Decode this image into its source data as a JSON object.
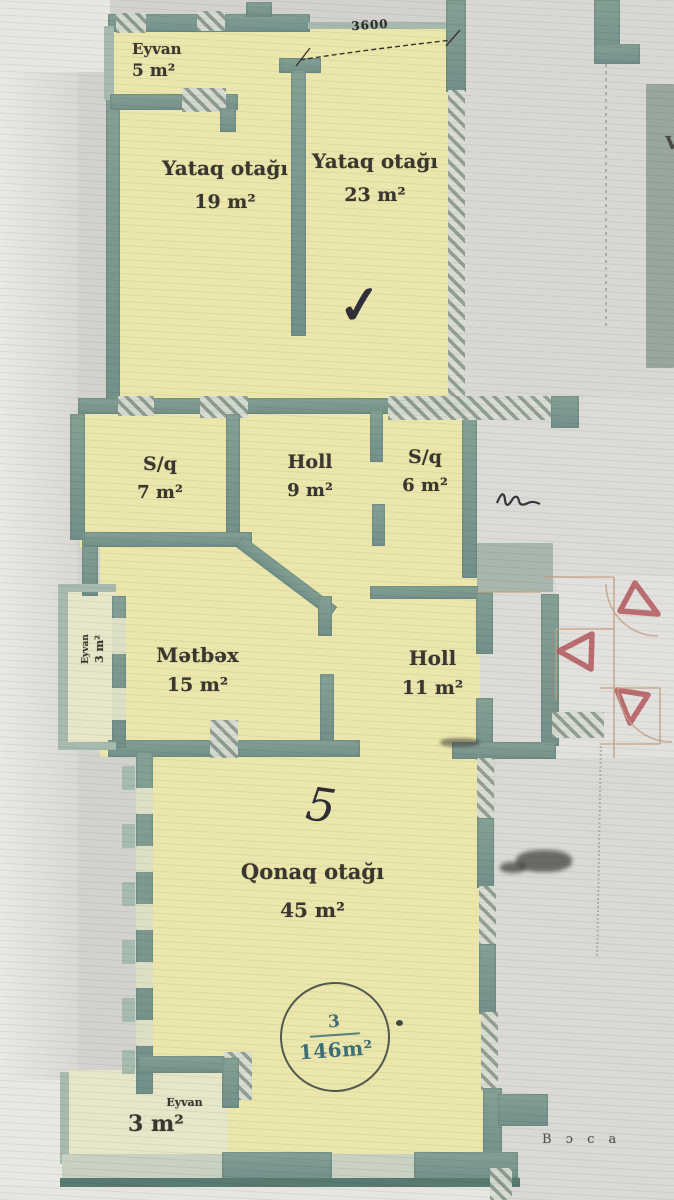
{
  "plan": {
    "rooms": [
      {
        "name": "Eyvan",
        "area": "5 m²"
      },
      {
        "name": "Yataq otağı",
        "area": "19 m²"
      },
      {
        "name": "Yataq otağı",
        "area": "23 m²"
      },
      {
        "name": "S/q",
        "area": "7 m²"
      },
      {
        "name": "Holl",
        "area": "9 m²"
      },
      {
        "name": "S/q",
        "area": "6 m²"
      },
      {
        "name": "Eyvan",
        "area": "3 m²"
      },
      {
        "name": "Mətbəx",
        "area": "15 m²"
      },
      {
        "name": "Holl",
        "area": "11 m²"
      },
      {
        "name": "Qonaq otağı",
        "area": "45 m²"
      },
      {
        "name": "Eyvan",
        "area": "3 m²"
      }
    ],
    "stamp": {
      "number": "3",
      "total_area": "146m²"
    },
    "dimensions": {
      "top_width": "3600"
    },
    "annotations": {
      "checkmark": "✓",
      "handwritten_number": "5",
      "edge_letter": "V",
      "bottom_right_text": "В ɔ с а"
    },
    "colors": {
      "room_fill": "#ebe7ac",
      "balcony_fill": "#e8e6c8",
      "wall": "#7e998e",
      "stamp_text": "#3e6f76",
      "triangle": "#b5585e",
      "ink": "#343138"
    }
  }
}
